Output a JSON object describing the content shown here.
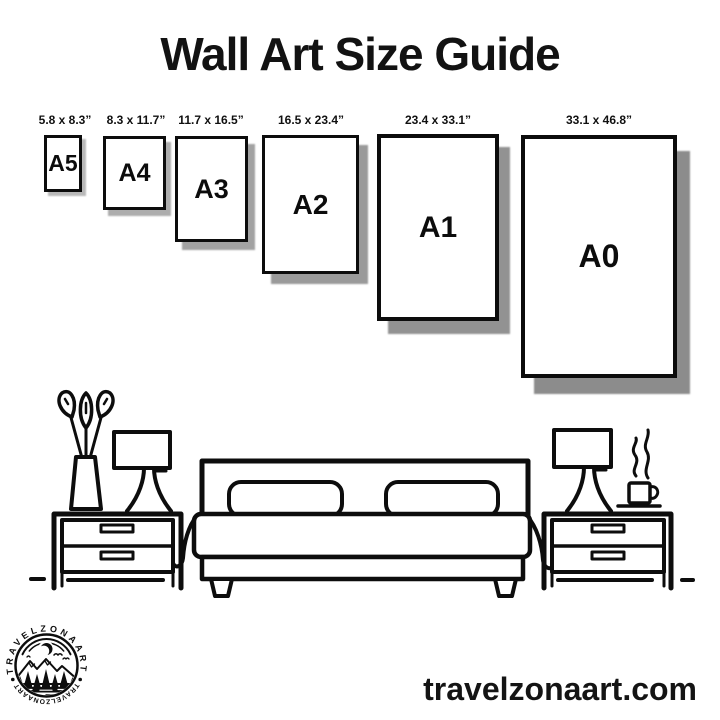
{
  "title": "Wall Art Size Guide",
  "frames": [
    {
      "name": "A5",
      "size_label": "5.8 x 8.3”"
    },
    {
      "name": "A4",
      "size_label": "8.3 x 11.7”"
    },
    {
      "name": "A3",
      "size_label": "11.7 x 16.5”"
    },
    {
      "name": "A2",
      "size_label": "16.5 x 23.4”"
    },
    {
      "name": "A1",
      "size_label": "23.4 x 33.1”"
    },
    {
      "name": "A0",
      "size_label": "33.1 x 46.8”"
    }
  ],
  "logo": {
    "arc_text_top": "TRAVELZONAART",
    "arc_text_bottom": "TRAVELZONAART"
  },
  "footer": {
    "website": "travelzonaart.com"
  },
  "colors": {
    "ink": "#0d0d0d",
    "shadow": "#8c8c8c",
    "background": "#ffffff"
  }
}
